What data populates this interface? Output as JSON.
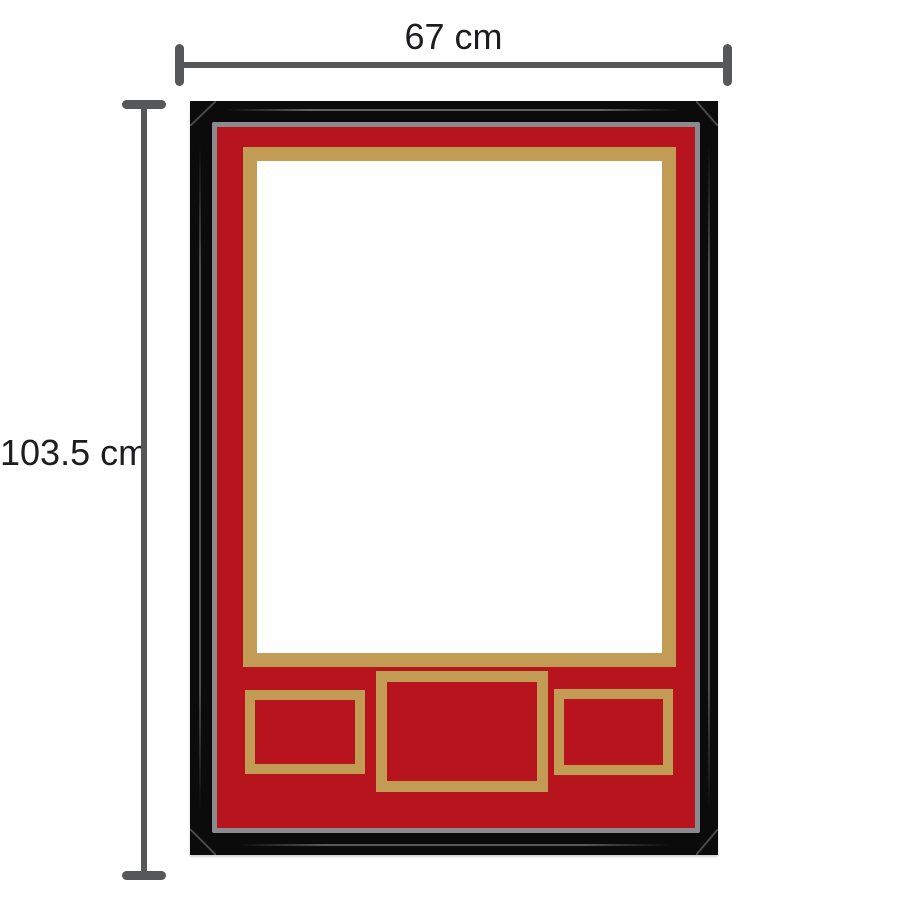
{
  "measurements": {
    "width": {
      "label": "67 cm"
    },
    "height": {
      "label": "103.5 cm"
    }
  },
  "colors": {
    "frame-black": "#0b0b0b",
    "liner-gray": "#8a8b8e",
    "mat-red": "#b8141e",
    "gold": "#c29b55",
    "opening-white": "#ffffff",
    "measure-gray": "#565759",
    "label-text": "#1d1d1f",
    "background": "#ffffff"
  }
}
